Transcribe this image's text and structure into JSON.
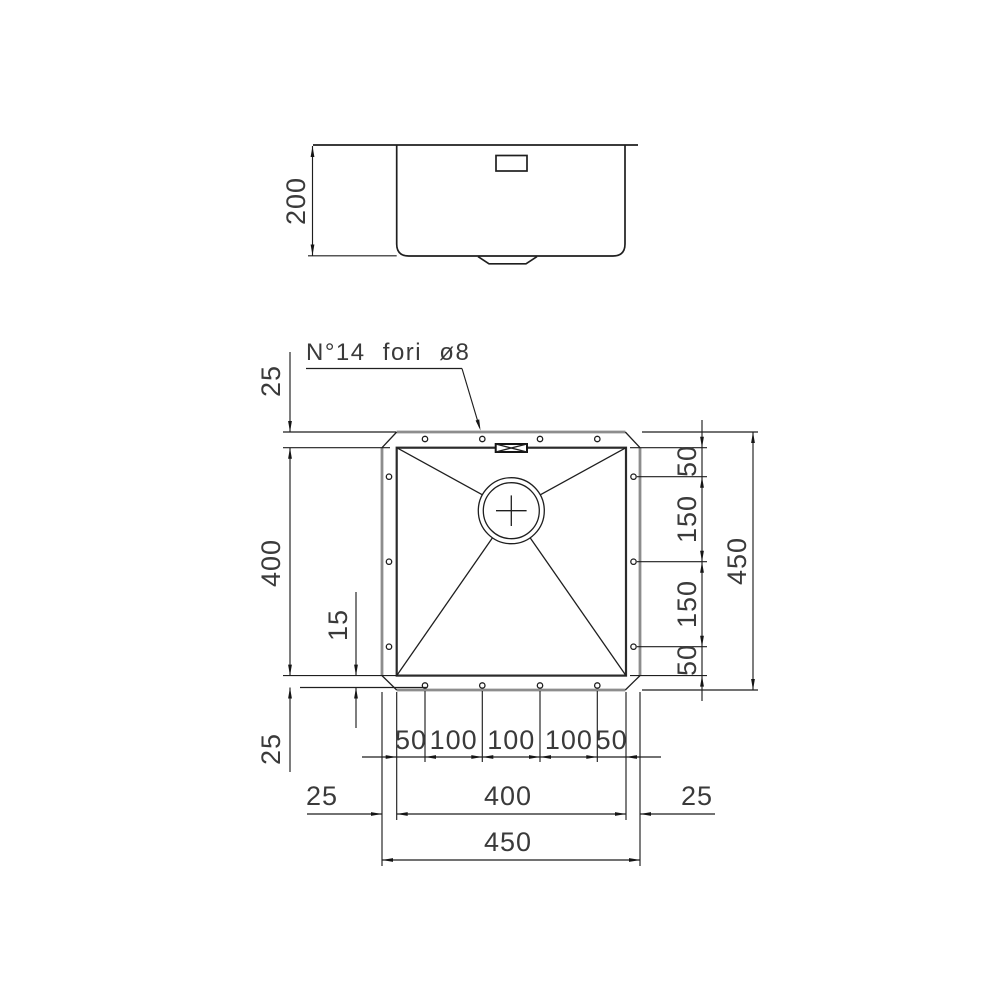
{
  "annotation": {
    "holes_note": "N°14 fori ø8"
  },
  "side_view": {
    "depth": "200"
  },
  "plan_view": {
    "top_flange": "25",
    "bowl_height": "400",
    "hole_inset": "15",
    "bottom_flange": "25",
    "right_spacings": [
      "50",
      "150",
      "150",
      "50"
    ],
    "overall_height": "450",
    "bottom_hole_spacings": [
      "50",
      "100",
      "100",
      "100",
      "50"
    ],
    "left_margin": "25",
    "bowl_width": "400",
    "right_margin": "25",
    "overall_width": "450"
  }
}
